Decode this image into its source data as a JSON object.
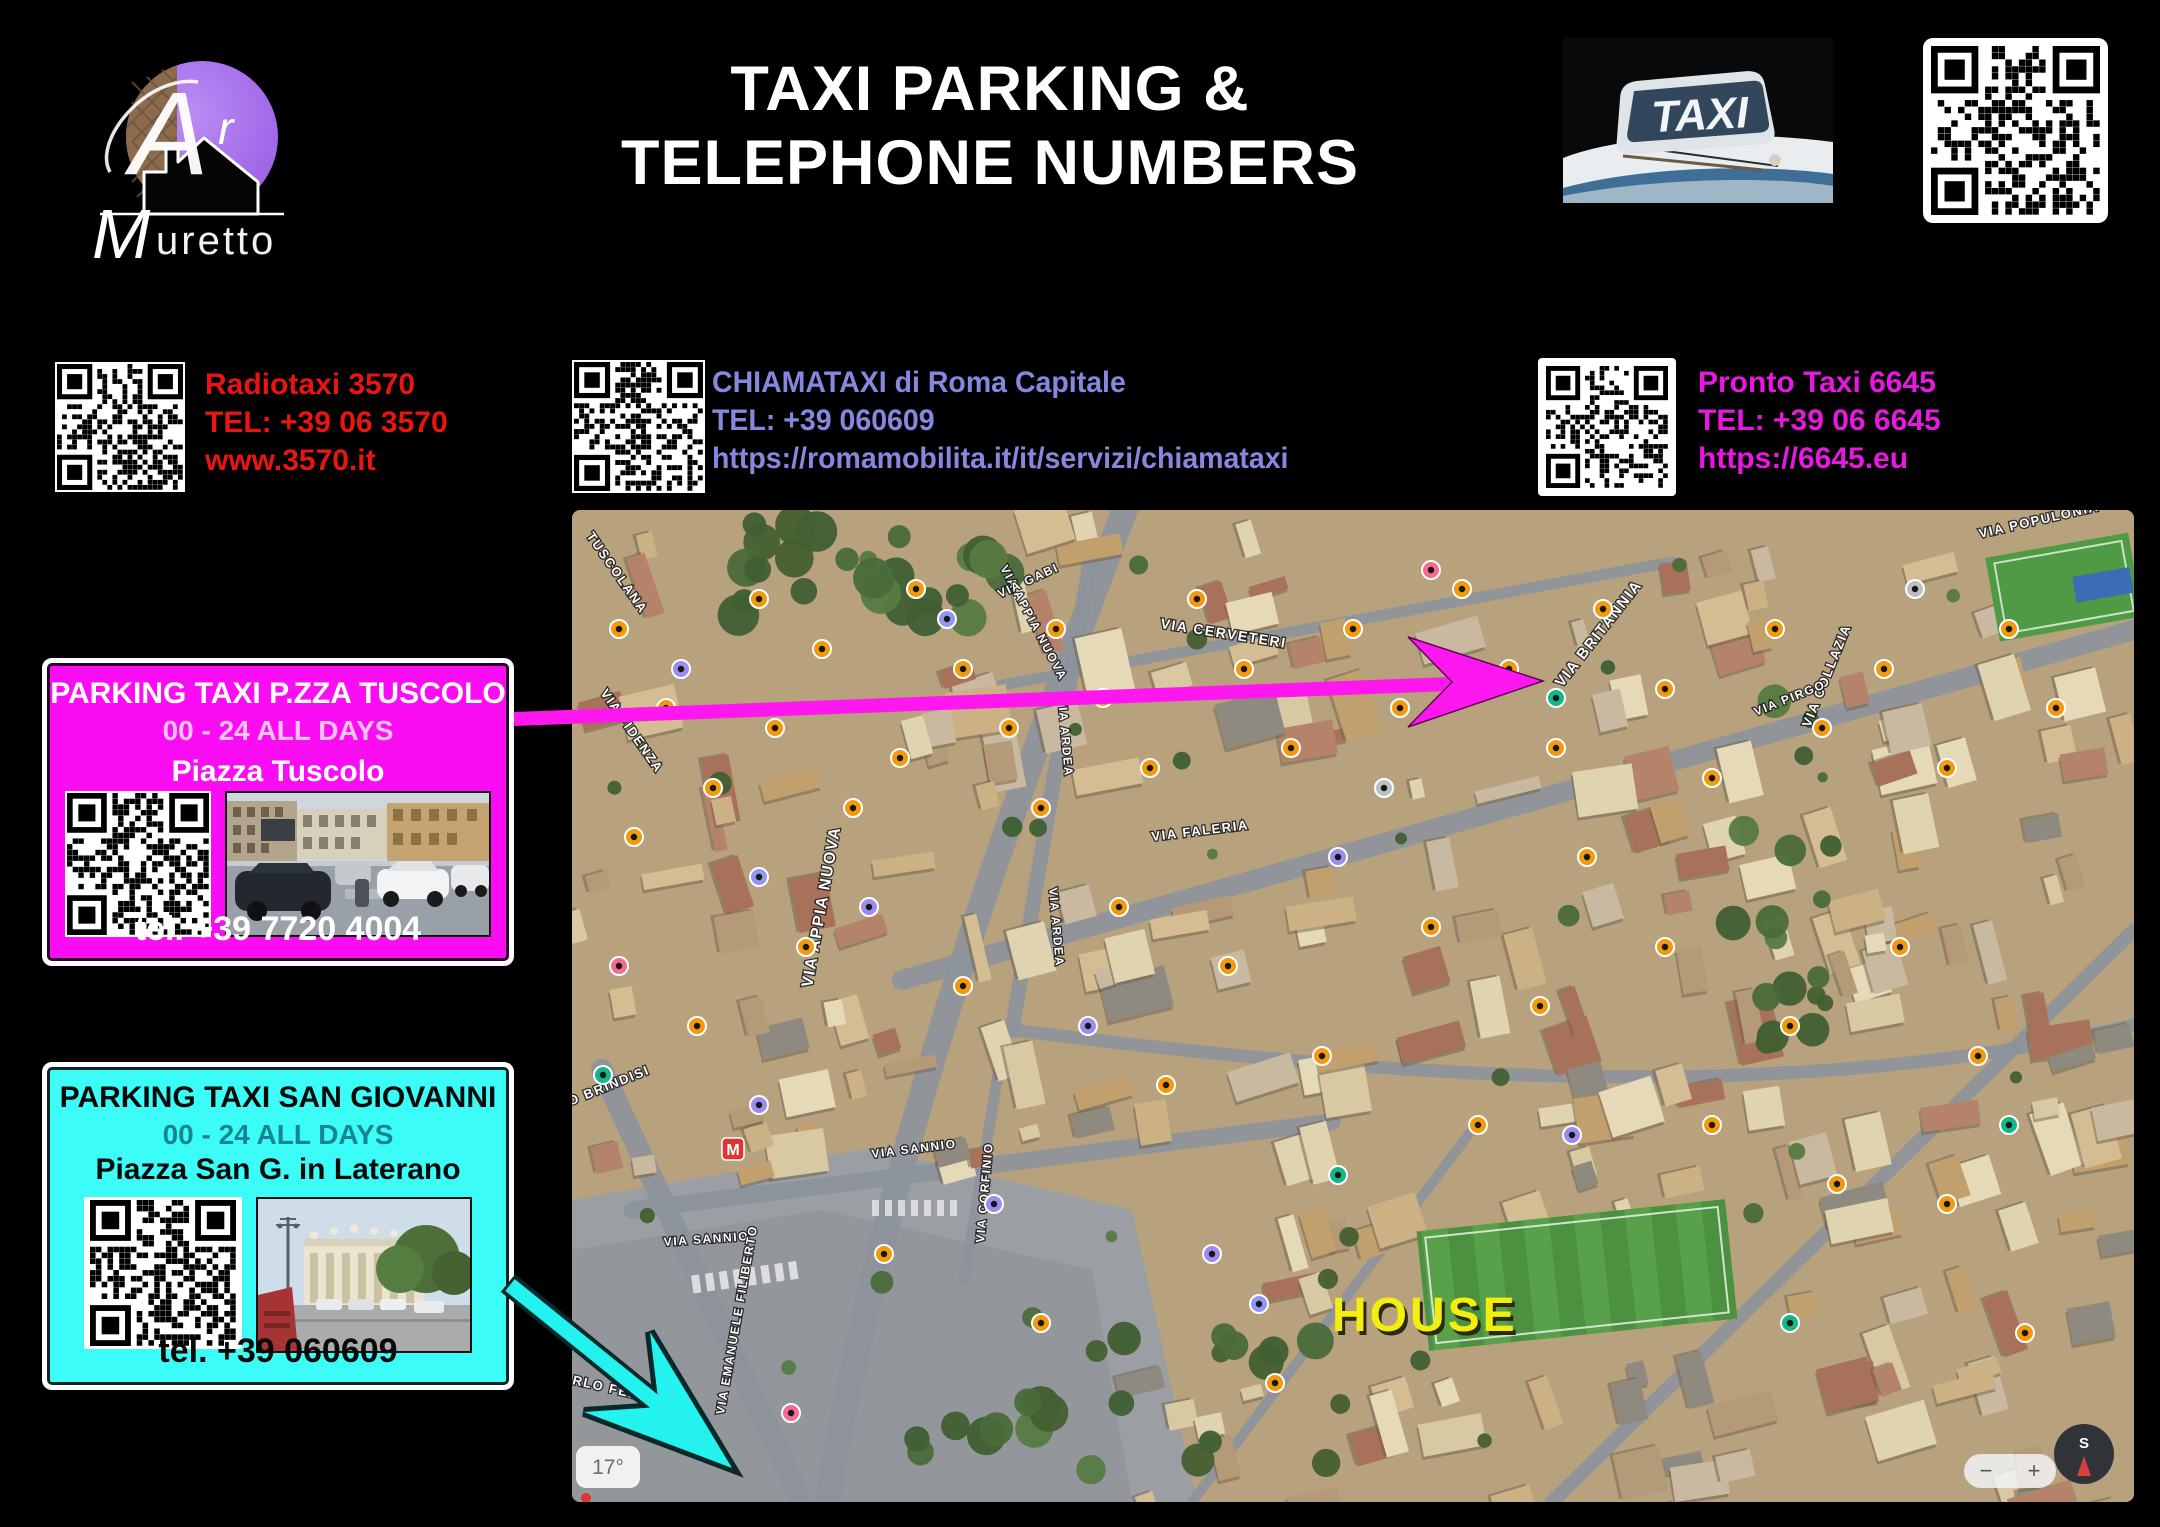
{
  "logo": {
    "brand_top": "Ar",
    "brand_bottom_initial": "M",
    "brand_bottom_rest": "uretto"
  },
  "header": {
    "title_line1": "TAXI PARKING &",
    "title_line2": "TELEPHONE NUMBERS"
  },
  "taxi_sign": {
    "label": "TAXI"
  },
  "contacts": [
    {
      "name": "Radiotaxi 3570",
      "tel": "TEL: +39 06 3570",
      "url": "www.3570.it",
      "color": "#e81510"
    },
    {
      "name": "CHIAMATAXI di Roma Capitale",
      "tel": "TEL: +39 060609",
      "url": "https://romamobilita.it/it/servizi/chiamataxi",
      "color": "#8688e0"
    },
    {
      "name": "Pronto Taxi 6645",
      "tel": "TEL: +39 06 6645",
      "url": "https://6645.eu",
      "color": "#e818e0"
    }
  ],
  "parking_boxes": [
    {
      "title": "PARKING TAXI P.ZZA TUSCOLO",
      "hours": "00 - 24 ALL DAYS",
      "place": "Piazza Tuscolo",
      "tel": "tel. +39 7720 4004",
      "bg": "#fb0df3",
      "title_color": "#ffffff",
      "hours_color": "#f9c4f1",
      "place_color": "#ffffff",
      "tel_color": "#ffffff",
      "arrow_color": "#ff17f0"
    },
    {
      "title": "PARKING TAXI SAN GIOVANNI",
      "hours": "00 - 24 ALL DAYS",
      "place": "Piazza San G. in Laterano",
      "tel": "tel. +39 060609",
      "bg": "#3cfcf8",
      "title_color": "#0a0a0a",
      "hours_color": "#17858f",
      "place_color": "#0a0a0a",
      "tel_color": "#0a0a0a",
      "arrow_color": "#23f2ee"
    }
  ],
  "map": {
    "house_label": "HOUSE",
    "house_color": "#f2ee0e",
    "metro_label": "M",
    "weather_chip": "17°",
    "compass_label": "S",
    "zoom_minus": "−",
    "zoom_plus": "+",
    "street_labels": [
      {
        "t": "TUSCOLANA",
        "x": 14,
        "y": 26,
        "r": 55,
        "s": 13
      },
      {
        "t": "VIA FIDENZA",
        "x": 28,
        "y": 183,
        "r": 55,
        "s": 13
      },
      {
        "t": "VIA APPIA NUOVA",
        "x": 428,
        "y": 58,
        "r": 62,
        "s": 12
      },
      {
        "t": "VIA APPIA NUOVA",
        "x": 240,
        "y": 478,
        "r": -80,
        "s": 16
      },
      {
        "t": "VIA CERVETERI",
        "x": 588,
        "y": 118,
        "r": 9,
        "s": 14
      },
      {
        "t": "VIA ARDEA",
        "x": 486,
        "y": 188,
        "r": 85,
        "s": 12
      },
      {
        "t": "VIA ARDEA",
        "x": 477,
        "y": 378,
        "r": 85,
        "s": 12
      },
      {
        "t": "VIA FALERIA",
        "x": 580,
        "y": 331,
        "r": -7,
        "s": 13
      },
      {
        "t": "VIA GABI",
        "x": 428,
        "y": 88,
        "r": -25,
        "s": 12
      },
      {
        "t": "VIA BRITANNIA",
        "x": 990,
        "y": 178,
        "r": -52,
        "s": 15
      },
      {
        "t": "VIA COLLAZIA",
        "x": 1238,
        "y": 218,
        "r": -68,
        "s": 13
      },
      {
        "t": "VIA PIRGO",
        "x": 1184,
        "y": 206,
        "r": -22,
        "s": 12
      },
      {
        "t": "VIA POPULONIA",
        "x": 1408,
        "y": 28,
        "r": -13,
        "s": 13
      },
      {
        "t": "VIA SANNIO",
        "x": 300,
        "y": 648,
        "r": -7,
        "s": 12
      },
      {
        "t": "VIA SANNIO",
        "x": 92,
        "y": 736,
        "r": -4,
        "s": 12
      },
      {
        "t": "VIA EMANUELE FILIBERTO",
        "x": 152,
        "y": 905,
        "r": -80,
        "s": 12
      },
      {
        "t": "VIA CORFINIO",
        "x": 412,
        "y": 733,
        "r": -85,
        "s": 12
      },
      {
        "t": "LARGO BRINDISI",
        "x": -42,
        "y": 612,
        "r": -22,
        "s": 13
      },
      {
        "t": "VIA CARLO FELICE",
        "x": -52,
        "y": 862,
        "r": 13,
        "s": 13
      }
    ],
    "markers": [
      [
        47,
        119,
        "o"
      ],
      [
        94,
        198,
        "o"
      ],
      [
        141,
        278,
        "o"
      ],
      [
        62,
        327,
        "o"
      ],
      [
        187,
        89,
        "o"
      ],
      [
        250,
        139,
        "o"
      ],
      [
        203,
        218,
        "o"
      ],
      [
        281,
        298,
        "o"
      ],
      [
        344,
        79,
        "o"
      ],
      [
        391,
        159,
        "o"
      ],
      [
        328,
        248,
        "o"
      ],
      [
        437,
        218,
        "o"
      ],
      [
        484,
        119,
        "o"
      ],
      [
        531,
        188,
        "o"
      ],
      [
        469,
        298,
        "o"
      ],
      [
        578,
        258,
        "o"
      ],
      [
        625,
        89,
        "o"
      ],
      [
        672,
        159,
        "o"
      ],
      [
        719,
        238,
        "o"
      ],
      [
        781,
        119,
        "o"
      ],
      [
        828,
        198,
        "o"
      ],
      [
        890,
        79,
        "o"
      ],
      [
        937,
        159,
        "o"
      ],
      [
        984,
        238,
        "o"
      ],
      [
        1031,
        99,
        "o"
      ],
      [
        1093,
        179,
        "o"
      ],
      [
        1140,
        268,
        "o"
      ],
      [
        1203,
        119,
        "o"
      ],
      [
        1250,
        218,
        "o"
      ],
      [
        1312,
        159,
        "o"
      ],
      [
        1375,
        258,
        "o"
      ],
      [
        1437,
        119,
        "o"
      ],
      [
        1484,
        198,
        "o"
      ],
      [
        547,
        397,
        "o"
      ],
      [
        656,
        456,
        "o"
      ],
      [
        859,
        417,
        "o"
      ],
      [
        968,
        496,
        "o"
      ],
      [
        1093,
        437,
        "o"
      ],
      [
        1218,
        516,
        "o"
      ],
      [
        1328,
        437,
        "o"
      ],
      [
        1406,
        546,
        "o"
      ],
      [
        391,
        476,
        "o"
      ],
      [
        234,
        437,
        "o"
      ],
      [
        125,
        516,
        "o"
      ],
      [
        750,
        546,
        "o"
      ],
      [
        906,
        615,
        "o"
      ],
      [
        594,
        575,
        "o"
      ],
      [
        1375,
        694,
        "o"
      ],
      [
        1453,
        823,
        "o"
      ],
      [
        312,
        744,
        "o"
      ],
      [
        469,
        813,
        "o"
      ],
      [
        703,
        873,
        "o"
      ],
      [
        1015,
        347,
        "o"
      ],
      [
        1140,
        615,
        "o"
      ],
      [
        1265,
        674,
        "o"
      ],
      [
        109,
        159,
        "p"
      ],
      [
        297,
        397,
        "p"
      ],
      [
        516,
        516,
        "p"
      ],
      [
        766,
        347,
        "p"
      ],
      [
        1000,
        625,
        "p"
      ],
      [
        187,
        595,
        "p"
      ],
      [
        422,
        694,
        "p"
      ],
      [
        640,
        744,
        "p"
      ],
      [
        984,
        188,
        "g"
      ],
      [
        31,
        565,
        "g"
      ],
      [
        766,
        665,
        "g"
      ],
      [
        1437,
        615,
        "g"
      ],
      [
        1218,
        813,
        "g"
      ],
      [
        859,
        60,
        "r"
      ],
      [
        47,
        456,
        "r"
      ],
      [
        219,
        903,
        "r"
      ],
      [
        375,
        109,
        "s"
      ],
      [
        187,
        367,
        "s"
      ],
      [
        687,
        794,
        "s"
      ],
      [
        812,
        278,
        "y"
      ],
      [
        1343,
        79,
        "y"
      ]
    ]
  }
}
